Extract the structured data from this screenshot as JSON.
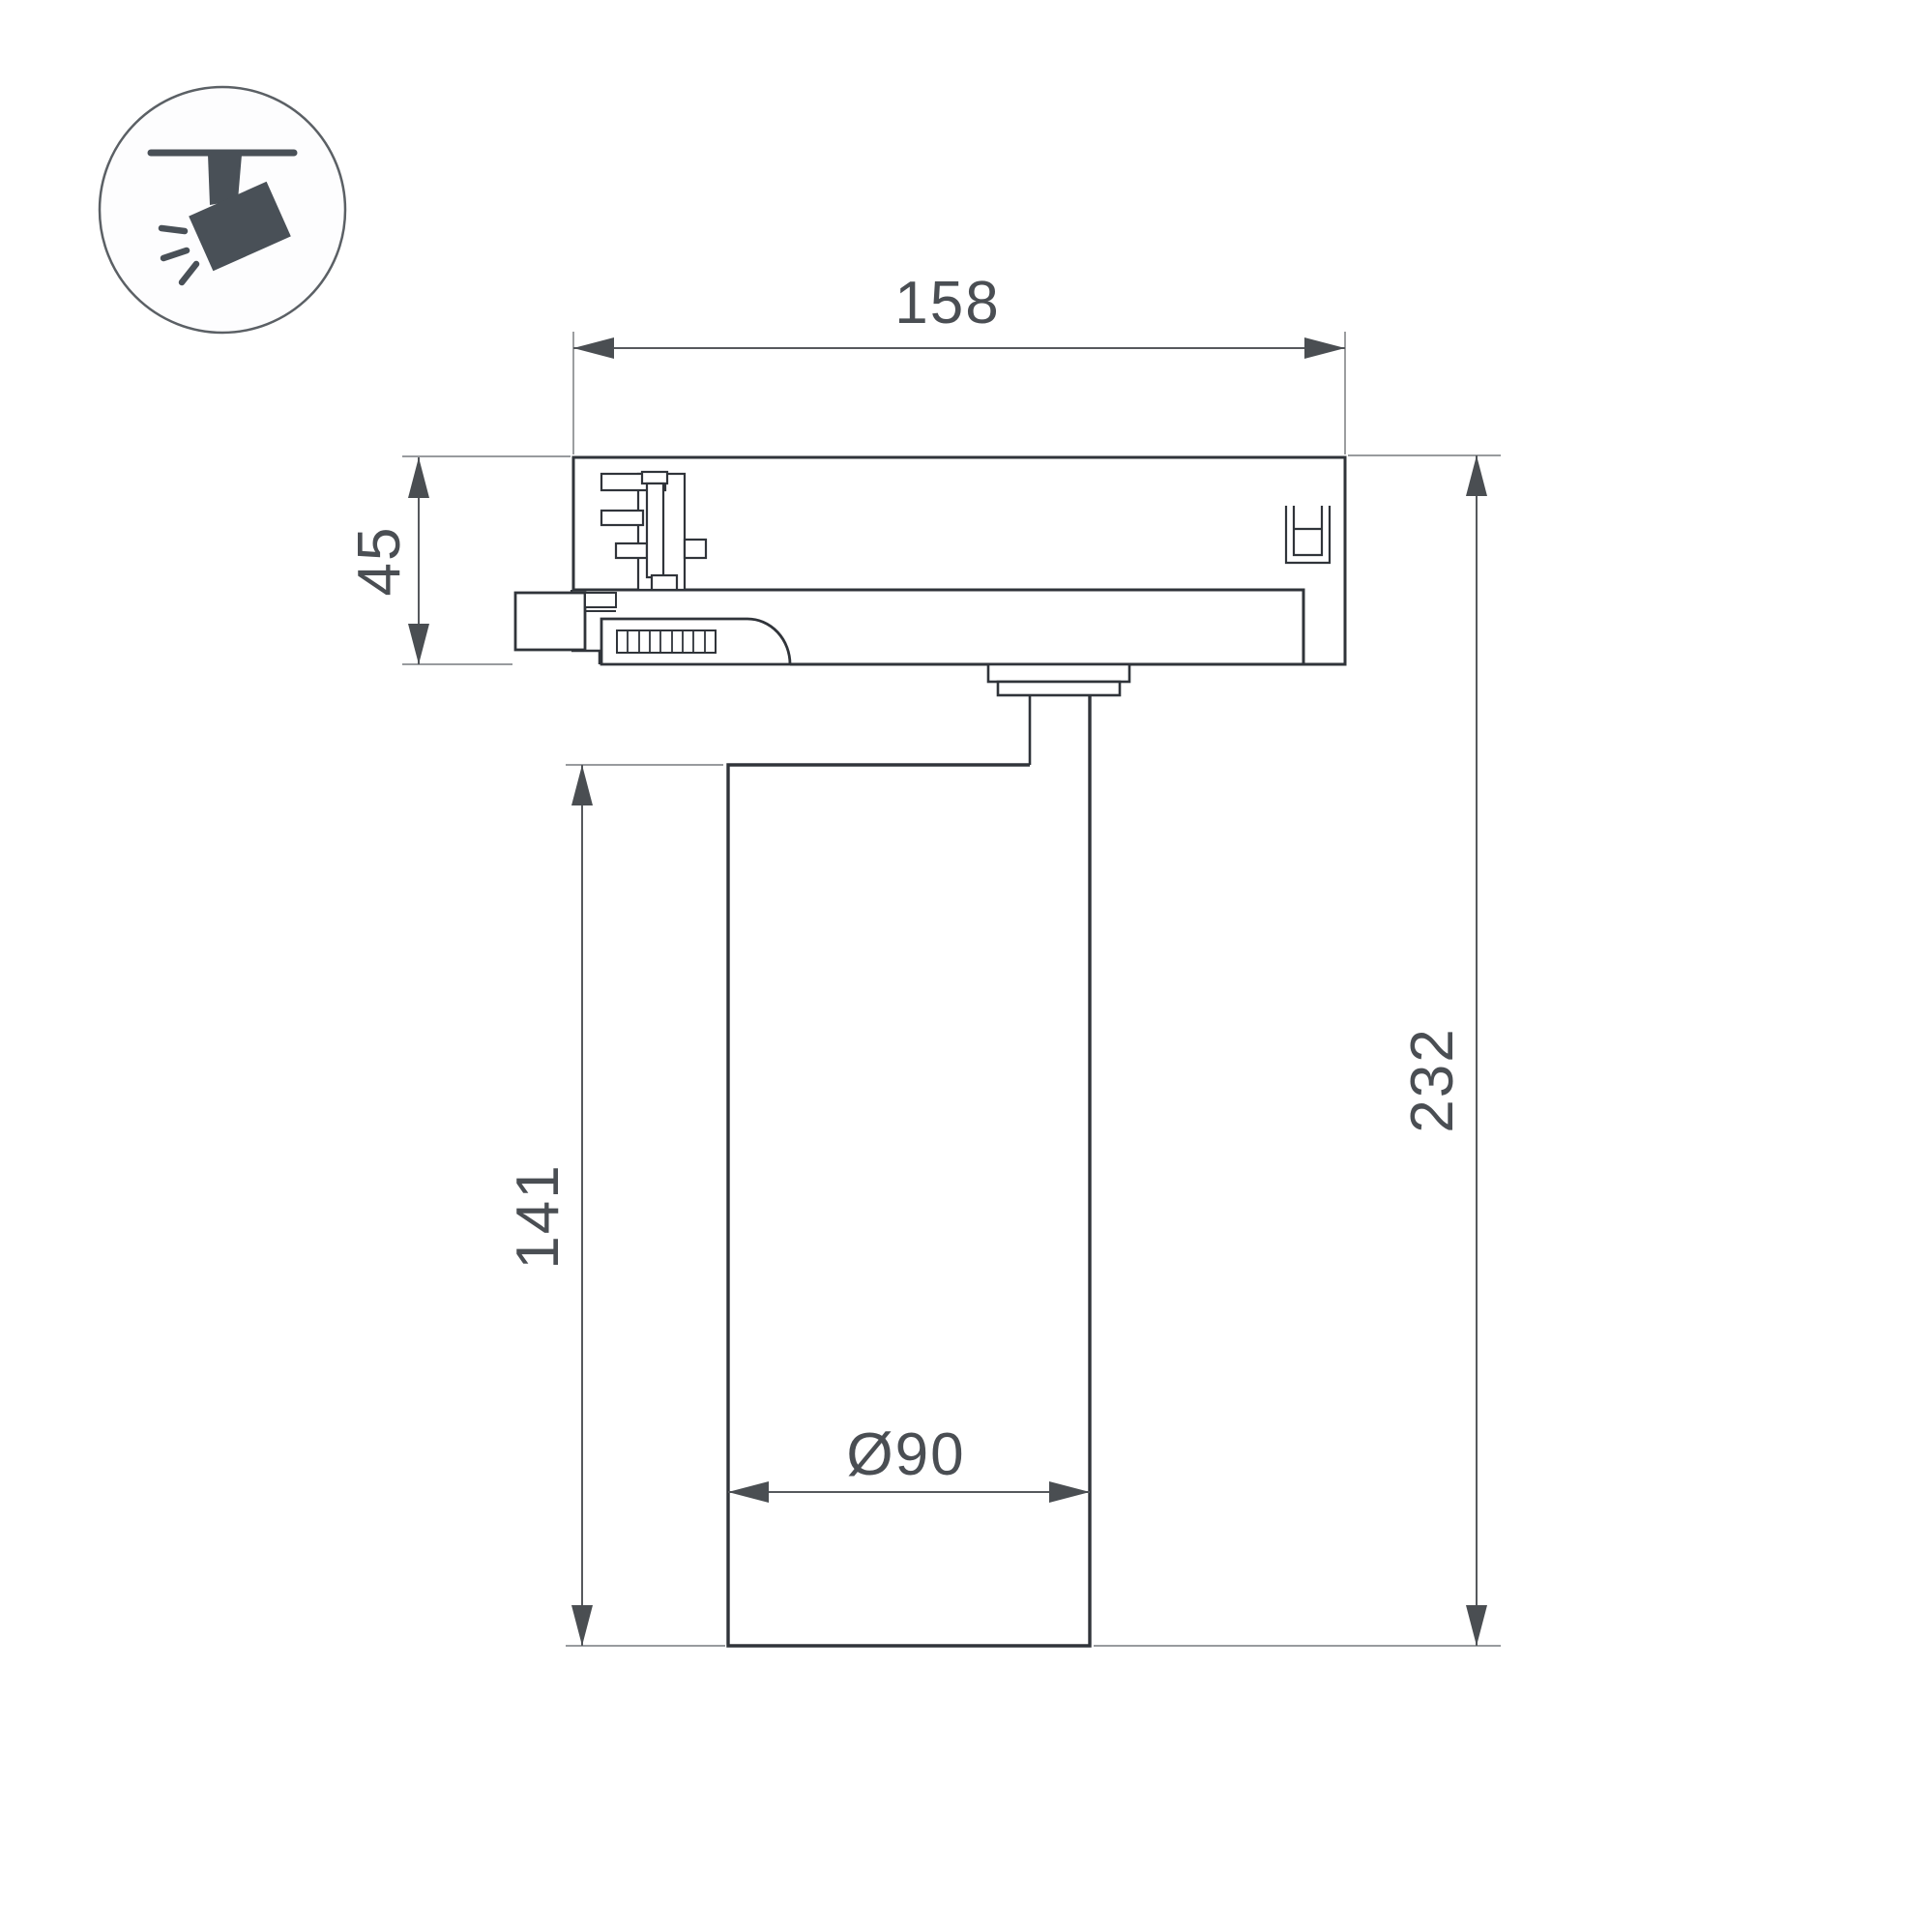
{
  "drawing": {
    "kind": "track-spotlight dimensional drawing",
    "dimensions": {
      "adapter_width": {
        "label": "158",
        "value_mm": 158,
        "orientation": "horizontal"
      },
      "adapter_height": {
        "label": "45",
        "value_mm": 45,
        "orientation": "vertical"
      },
      "body_height": {
        "label": "141",
        "value_mm": 141,
        "orientation": "vertical"
      },
      "total_height": {
        "label": "232",
        "value_mm": 232,
        "orientation": "vertical"
      },
      "body_diameter": {
        "label": "Ø90",
        "value_mm": 90,
        "orientation": "horizontal"
      }
    }
  },
  "icon": {
    "name": "track-spotlight-icon",
    "color": "#495057"
  },
  "colors": {
    "background": "#ffffff",
    "outline": "#30343a",
    "dimension_line": "#56595d",
    "extension_line": "#8a8d90",
    "arrow": "#4a4e52",
    "text": "#4a4e53",
    "icon_circle_stroke": "#5b6065"
  }
}
